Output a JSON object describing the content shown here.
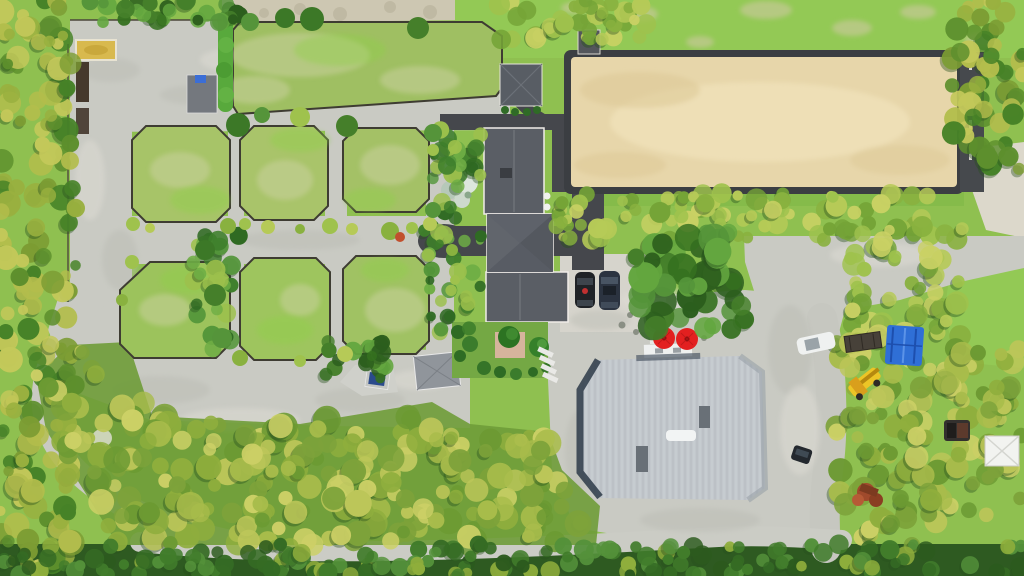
{
  "meta": {
    "description": "Top-down aerial drone photograph of an equestrian estate: fenced grass paddocks on the left, a sand riding arena at top right, a dark-roofed house in the center, a large metal-roofed barn below it, gravel driveways, an orchard of trees along the bottom, and service vehicles on the right.",
    "image_type": "aerial-photograph",
    "width_px": 1024,
    "height_px": 576
  },
  "colors": {
    "base_lawn": "#8fc050",
    "lawn_bright": "#93c955",
    "paddock_grass": "#a7c468",
    "paddock_grass_bright": "#9cc35c",
    "dry_patch": "#ccd2a2",
    "dirt": "#cdc7b2",
    "gravel": "#c9cac3",
    "gravel_light": "#d6d4cc",
    "gravel_dark": "#b8b9b1",
    "asphalt": "#45474c",
    "arena_sand": "#e7d6aa",
    "arena_sand_light": "#f1e3ba",
    "arena_border": "#3b3e42",
    "house_roof": "#5a5e65",
    "house_roof_light": "#61656c",
    "house_roof_dark": "#54585f",
    "shed_roof": "#74787e",
    "barn_roof": "#c2c7cc",
    "barn_shadow": "#2d3a48",
    "barn_vent": "#697077",
    "umbrella_red": "#e32020",
    "umbrella_dark": "#8a1010",
    "tarp_blue": "#2f6fd6",
    "machine_yellow": "#ecc526",
    "deck_white": "#eff1f0",
    "hedge_green": "#58a93c",
    "sand_pad": "#d8b94e",
    "bench_brown": "#46392c",
    "fence": "#3e3c32",
    "white_ground": "#dcd8cb",
    "pink_patio": "#d6b49c",
    "silver_tree": "#dce6dc",
    "rust": "#a04a2c",
    "car_dark": "#1f2226",
    "car_suv": "#2b3340",
    "car_white": "#eff1f0",
    "truck_dark": "#33302e",
    "trailer_brown": "#474139",
    "orchard_base": "#6f9c38",
    "bottom_band": "#2e5a21"
  },
  "palettes": {
    "dark": [
      "#35701f",
      "#457f2a",
      "#55943a",
      "#2c5e1d",
      "#63a63f"
    ],
    "darkB": [
      "#2c5a1e",
      "#356b24",
      "#417c2b",
      "#54913a",
      "#8fae3c"
    ],
    "orchard": [
      "#a8bc4b",
      "#8fae3d",
      "#bcc659",
      "#7da23a",
      "#ccd066",
      "#6c9a33"
    ],
    "palm": [
      "#9fc24d",
      "#b6ca57",
      "#89b13f",
      "#c9d164",
      "#75a437"
    ],
    "leftmix": [
      "#b3bd4c",
      "#99b03f",
      "#7c9c33",
      "#c3c85a",
      "#5d8f2d",
      "#468227"
    ],
    "housel": [
      "#3e7e2b",
      "#54963a",
      "#6fae45",
      "#9cc04c",
      "#2f6a22"
    ]
  },
  "inventory": {
    "paddocks": 7,
    "riding_arena": 1,
    "main_house": 1,
    "barn": 1,
    "sheds": 4,
    "red_umbrellas": 2,
    "parked_cars_by_house": 2,
    "white_car": 1,
    "utility_trailer": 1,
    "blue_tarp_structure": 1,
    "yellow_loader": 1,
    "white_canopy_tent": 1,
    "pickup_truck": 1,
    "rusty_equipment": 1,
    "sand_warmup_pad": 1
  }
}
